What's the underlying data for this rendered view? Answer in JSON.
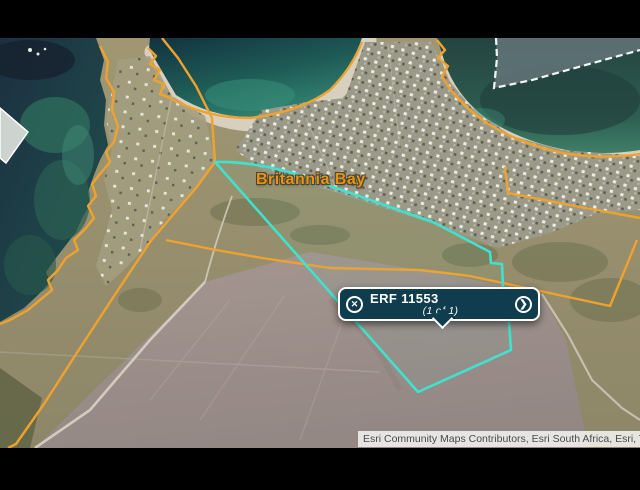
{
  "map": {
    "label_britannia_bay": "Britannia Bay",
    "attribution": "Esri Community Maps Contributors, Esri South Africa, Esri, T",
    "colors": {
      "parcel_outline": "#3FE2CD",
      "cadastral_boundary": "#F0A22E",
      "popup_background": "#0F3D4D",
      "place_label": "#E8940C"
    }
  },
  "popup": {
    "title": "ERF 11553",
    "pagination": "(1 of 1)",
    "close_icon": "✕",
    "next_icon": "❯"
  }
}
